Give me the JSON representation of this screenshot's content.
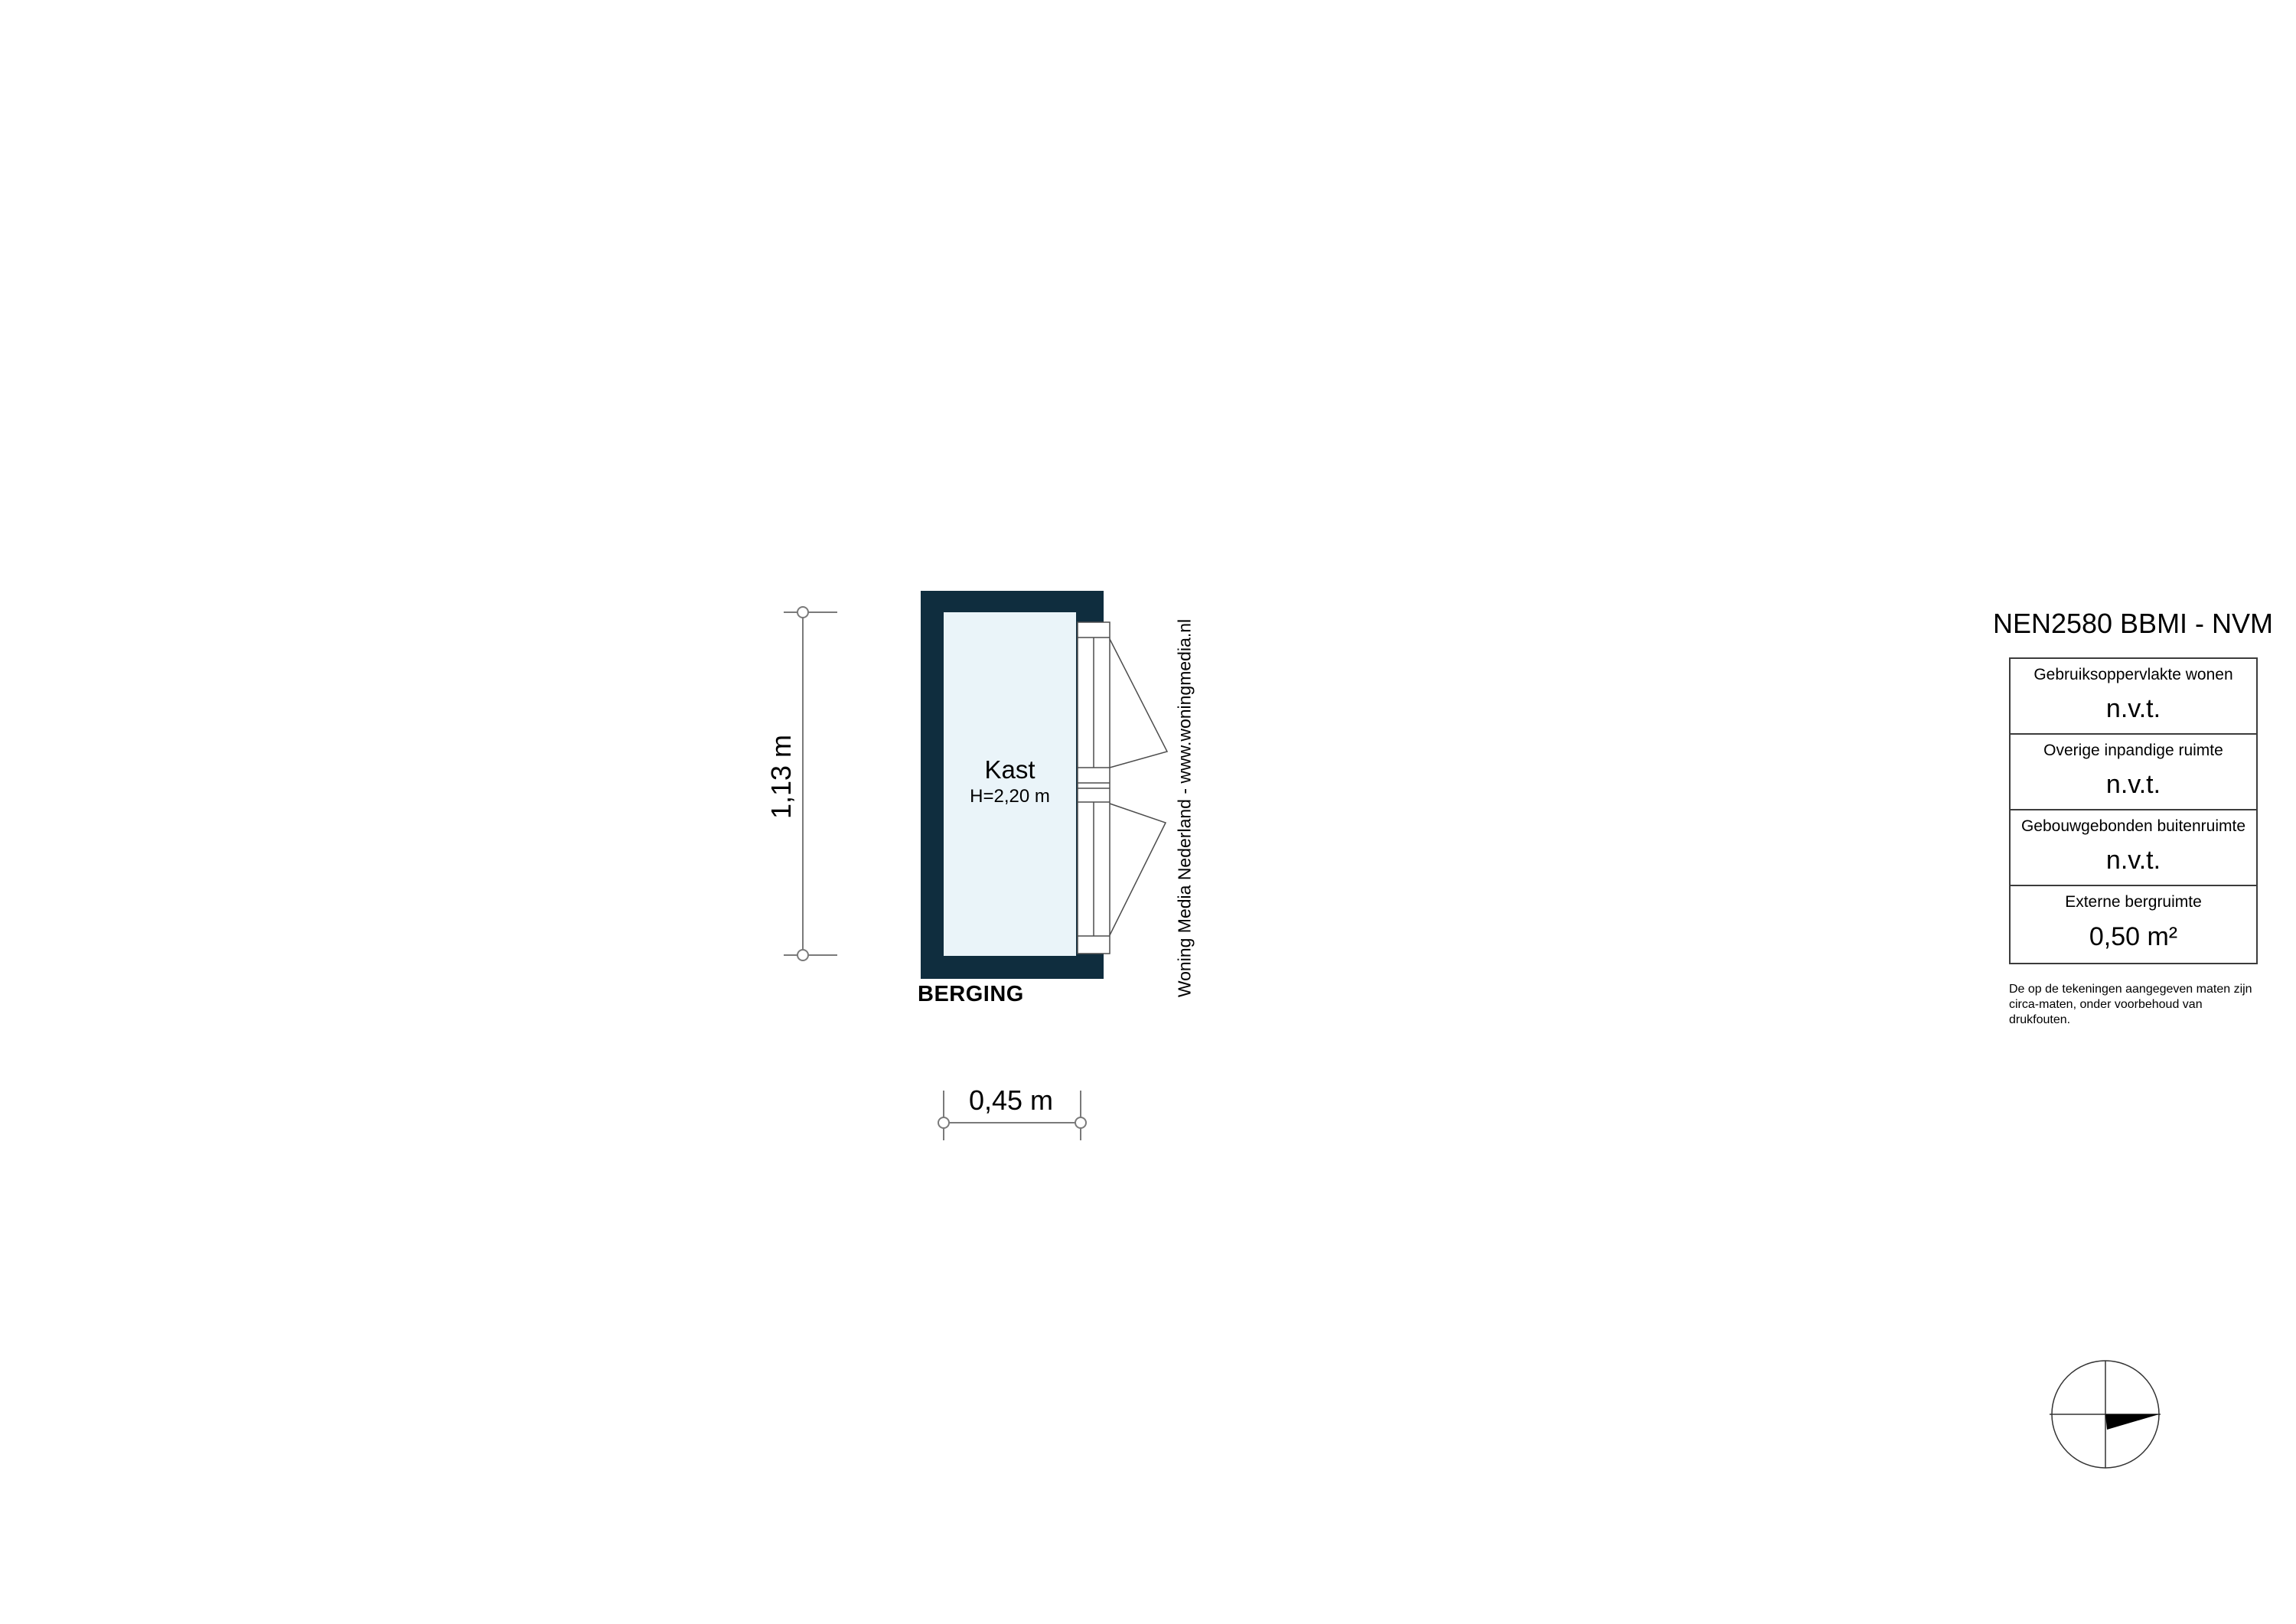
{
  "floorplan": {
    "area_label": "BERGING",
    "room": {
      "name": "Kast",
      "height_label": "H=2,20 m"
    },
    "dimensions": {
      "vertical": "1,13 m",
      "horizontal": "0,45 m"
    }
  },
  "watermark": {
    "text": "Woning Media Nederland - www.woningmedia.nl"
  },
  "legend": {
    "title": "NEN2580 BBMI - NVM",
    "rows": [
      {
        "label": "Gebruiksoppervlakte wonen",
        "value": "n.v.t."
      },
      {
        "label": "Overige inpandige ruimte",
        "value": "n.v.t."
      },
      {
        "label": "Gebouwgebonden buitenruimte",
        "value": "n.v.t."
      },
      {
        "label": "Externe bergruimte",
        "value": "0,50 m²"
      }
    ],
    "disclaimer": "De op de tekeningen aangegeven maten zijn circa-maten, onder voorbehoud van drukfouten."
  },
  "icons": {
    "compass": "north-arrow-pointing-right"
  },
  "colors": {
    "wall": "#0f2d3e",
    "room_fill": "#eaf4f9",
    "drawing_line": "#7a7a7a",
    "door_line": "#4d4d4d",
    "text": "#000000"
  }
}
